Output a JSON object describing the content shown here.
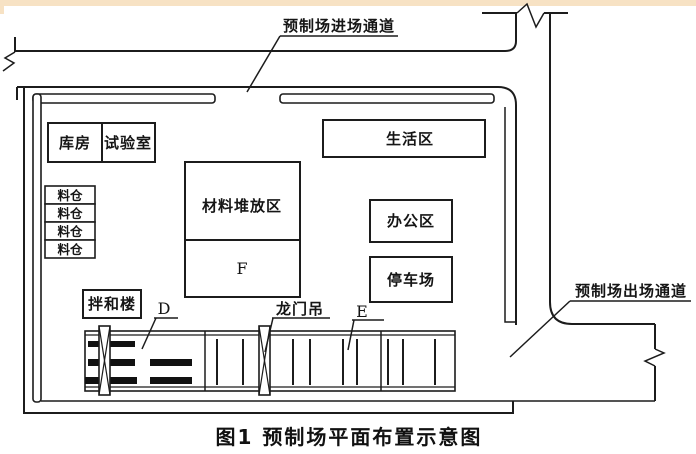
{
  "caption": "图1  预制场平面布置示意图",
  "roads": {
    "entry_label": "预制场进场通道",
    "exit_label": "预制场出场通道"
  },
  "buildings": {
    "warehouse": "库房",
    "laboratory": "试验室",
    "bins": [
      "料仓",
      "料仓",
      "料仓",
      "料仓"
    ],
    "material_yard": "材料堆放区",
    "material_yard_sub": "F",
    "living_area": "生活区",
    "office_area": "办公区",
    "parking_lot": "停车场",
    "mixing_plant": "拌和楼"
  },
  "markers": {
    "d": "D",
    "e": "E",
    "gantry_crane": "龙门吊"
  },
  "colors": {
    "ink": "#1c1c1c",
    "paper": "#ffffff",
    "scan_edge": "#f7e2c4"
  }
}
